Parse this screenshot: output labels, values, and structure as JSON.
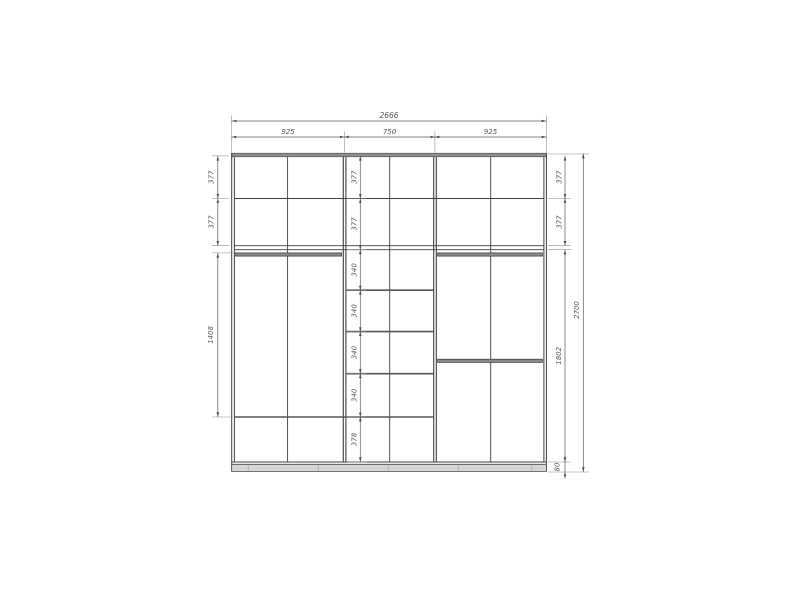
{
  "drawing": {
    "kind": "wardrobe-elevation-drawing",
    "dims": {
      "total_width": "2666",
      "total_height": "2700",
      "top_sections": [
        "925",
        "750",
        "925"
      ],
      "left_column": [
        "377",
        "377",
        "1408"
      ],
      "middle_column": [
        "377",
        "377",
        "340",
        "340",
        "340",
        "340",
        "378"
      ],
      "right_column": [
        "377",
        "377",
        "1802",
        "80"
      ]
    },
    "colors": {
      "structure_line": "#3f3f3f",
      "dimension_line": "#5a5a5a",
      "label_text": "#565656",
      "panel_fill": "#909090",
      "plinth_fill": "#d6d6d6"
    }
  }
}
